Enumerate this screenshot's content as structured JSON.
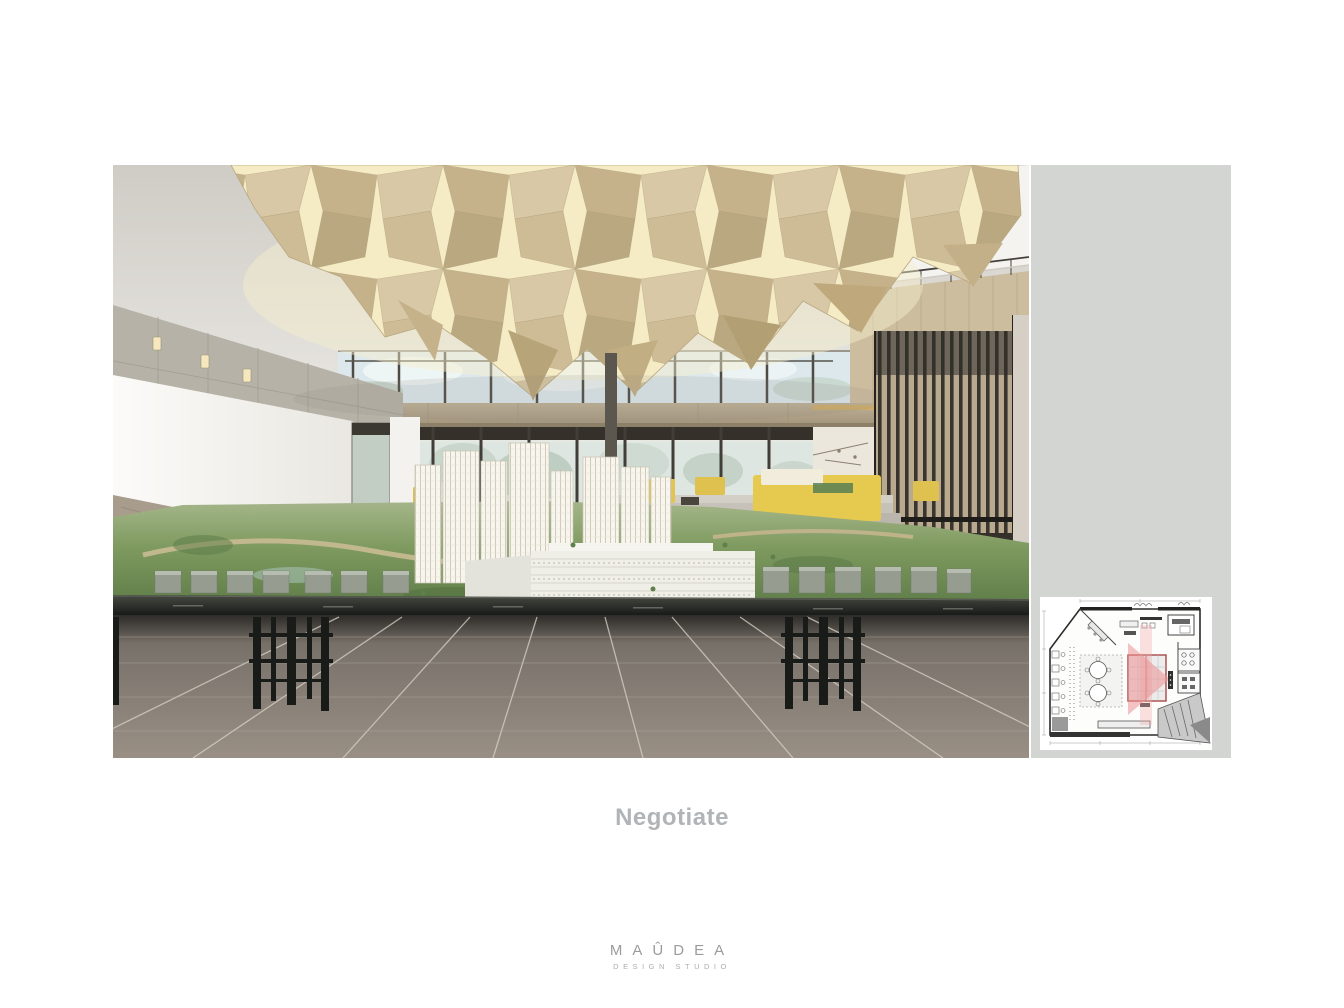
{
  "slide": {
    "caption": "Negotiate",
    "logo": {
      "wordmark": "MAÛDEA",
      "subtitle": "DESIGN STUDIO"
    }
  },
  "colors": {
    "page_background": "#ffffff",
    "side_panel_gray": "#d3d5d2",
    "caption_text": "#b1b4b6",
    "logo_text": "#9b9b9b",
    "ceiling_glow": "#f6edc8",
    "ceiling_panel_tan": "#cdbb96",
    "model_landscape_green": "#7e9a5f",
    "furniture_accent_yellow": "#e6c94f",
    "floor_plan_highlight_pink": "#ec9292",
    "floor_plan_table_outline_red": "#a84848"
  }
}
